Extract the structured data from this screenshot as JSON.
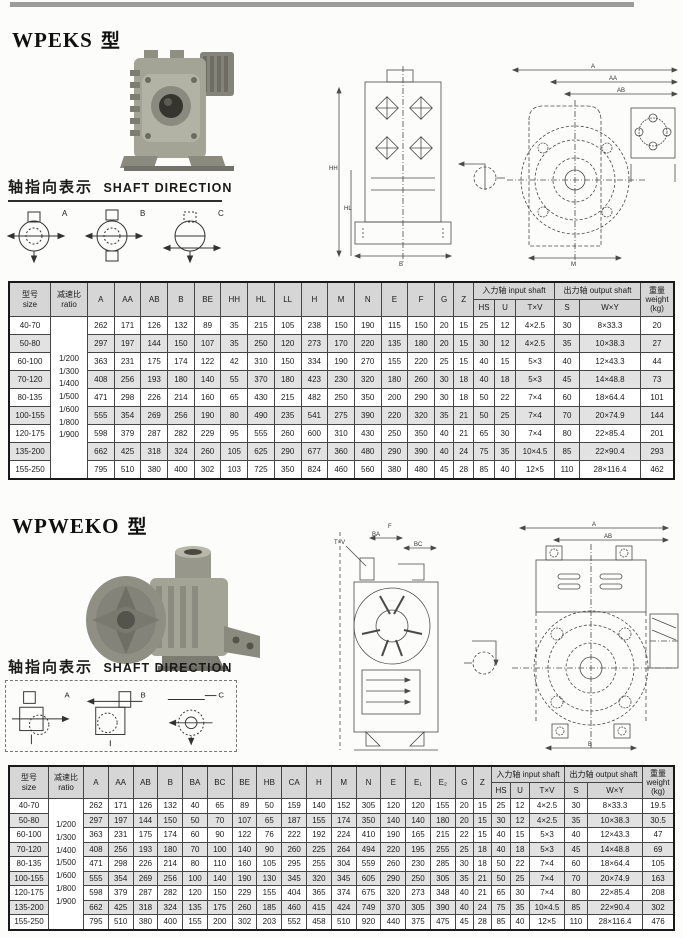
{
  "page": {
    "kind": "gear-reducer-catalog-page"
  },
  "sections": {
    "wpeks": {
      "title": "WPEKS",
      "type_suffix": "型",
      "shaft_direction_zh": "轴指向表示",
      "shaft_direction_en": "SHAFT DIRECTION",
      "sketch_labels": [
        "A",
        "B",
        "C"
      ],
      "drawing_front_labels": [
        "HH",
        "HL",
        "B"
      ],
      "drawing_side_labels": [
        "A",
        "AA",
        "AB",
        "M"
      ]
    },
    "wpweko": {
      "title": "WPWEKO",
      "type_suffix": "型",
      "shaft_direction_zh": "轴指向表示",
      "shaft_direction_en": "SHAFT DIRECTION",
      "sketch_labels": [
        "A",
        "B",
        "C"
      ],
      "drawing_left_labels": [
        "T×V",
        "F",
        "BA",
        "BC"
      ],
      "drawing_front_labels": [
        "A",
        "AB",
        "B"
      ]
    }
  },
  "tables": {
    "wpeks": {
      "header_rows": [
        [
          {
            "t": "型号\nsize",
            "rs": 2,
            "w": 38
          },
          {
            "t": "减速比\nratio",
            "rs": 2,
            "w": 34
          },
          {
            "t": "A",
            "rs": 2
          },
          {
            "t": "AA",
            "rs": 2
          },
          {
            "t": "AB",
            "rs": 2
          },
          {
            "t": "B",
            "rs": 2
          },
          {
            "t": "BE",
            "rs": 2
          },
          {
            "t": "HH",
            "rs": 2
          },
          {
            "t": "HL",
            "rs": 2
          },
          {
            "t": "LL",
            "rs": 2
          },
          {
            "t": "H",
            "rs": 2
          },
          {
            "t": "M",
            "rs": 2
          },
          {
            "t": "N",
            "rs": 2
          },
          {
            "t": "E",
            "rs": 2
          },
          {
            "t": "F",
            "rs": 2
          },
          {
            "t": "G",
            "rs": 2
          },
          {
            "t": "Z",
            "rs": 2
          },
          {
            "t": "入力轴 input shaft",
            "cs": 3
          },
          {
            "t": "出力轴 output shaft",
            "cs": 2
          },
          {
            "t": "重量\nweight\n(kg)",
            "rs": 2,
            "w": 30
          }
        ],
        [
          {
            "t": "HS",
            "w": 18
          },
          {
            "t": "U",
            "w": 18
          },
          {
            "t": "T×V",
            "w": 36
          },
          {
            "t": "S",
            "w": 22
          },
          {
            "t": "W×Y",
            "w": 58
          }
        ]
      ],
      "ratios": [
        "1/200",
        "1/300",
        "1/400",
        "1/500",
        "1/600",
        "1/800",
        "1/900"
      ],
      "rows": [
        {
          "size": "40-70",
          "values": [
            262,
            171,
            126,
            132,
            89,
            35,
            215,
            105,
            238,
            150,
            190,
            115,
            150,
            20,
            15,
            25,
            12,
            "4×2.5",
            30,
            "8×33.3",
            20
          ]
        },
        {
          "size": "50-80",
          "values": [
            297,
            197,
            144,
            150,
            107,
            35,
            250,
            120,
            273,
            170,
            220,
            135,
            180,
            20,
            15,
            30,
            12,
            "4×2.5",
            35,
            "10×38.3",
            27
          ]
        },
        {
          "size": "60-100",
          "values": [
            363,
            231,
            175,
            174,
            122,
            42,
            310,
            150,
            334,
            190,
            270,
            155,
            220,
            25,
            15,
            40,
            15,
            "5×3",
            40,
            "12×43.3",
            44
          ]
        },
        {
          "size": "70-120",
          "values": [
            408,
            256,
            193,
            180,
            140,
            55,
            370,
            180,
            423,
            230,
            320,
            180,
            260,
            30,
            18,
            40,
            18,
            "5×3",
            45,
            "14×48.8",
            73
          ]
        },
        {
          "size": "80-135",
          "values": [
            471,
            298,
            226,
            214,
            160,
            65,
            430,
            215,
            482,
            250,
            350,
            200,
            290,
            30,
            18,
            50,
            22,
            "7×4",
            60,
            "18×64.4",
            101
          ]
        },
        {
          "size": "100-155",
          "values": [
            555,
            354,
            269,
            256,
            190,
            80,
            490,
            235,
            541,
            275,
            390,
            220,
            320,
            35,
            21,
            50,
            25,
            "7×4",
            70,
            "20×74.9",
            144
          ]
        },
        {
          "size": "120-175",
          "values": [
            598,
            379,
            287,
            282,
            229,
            95,
            555,
            260,
            600,
            310,
            430,
            250,
            350,
            40,
            21,
            65,
            30,
            "7×4",
            80,
            "22×85.4",
            201
          ]
        },
        {
          "size": "135-200",
          "values": [
            662,
            425,
            318,
            324,
            260,
            105,
            625,
            290,
            677,
            360,
            480,
            290,
            390,
            40,
            24,
            75,
            35,
            "10×4.5",
            85,
            "22×90.4",
            293
          ]
        },
        {
          "size": "155-250",
          "values": [
            795,
            510,
            380,
            400,
            302,
            103,
            725,
            350,
            824,
            460,
            560,
            380,
            480,
            45,
            28,
            85,
            40,
            "12×5",
            110,
            "28×116.4",
            462
          ]
        }
      ]
    },
    "wpweko": {
      "header_rows": [
        [
          {
            "t": "型号\nsize",
            "rs": 2,
            "w": 36
          },
          {
            "t": "减速比\nratio",
            "rs": 2,
            "w": 32
          },
          {
            "t": "A",
            "rs": 2
          },
          {
            "t": "AA",
            "rs": 2
          },
          {
            "t": "AB",
            "rs": 2
          },
          {
            "t": "B",
            "rs": 2
          },
          {
            "t": "BA",
            "rs": 2
          },
          {
            "t": "BC",
            "rs": 2
          },
          {
            "t": "BE",
            "rs": 2
          },
          {
            "t": "HB",
            "rs": 2
          },
          {
            "t": "CA",
            "rs": 2
          },
          {
            "t": "H",
            "rs": 2
          },
          {
            "t": "M",
            "rs": 2
          },
          {
            "t": "N",
            "rs": 2
          },
          {
            "t": "E",
            "rs": 2
          },
          {
            "t": "E₁",
            "rs": 2
          },
          {
            "t": "E₂",
            "rs": 2
          },
          {
            "t": "G",
            "rs": 2
          },
          {
            "t": "Z",
            "rs": 2
          },
          {
            "t": "入力轴 input shaft",
            "cs": 3
          },
          {
            "t": "出力轴 output shaft",
            "cs": 2
          },
          {
            "t": "重量\nweight\n(kg)",
            "rs": 2,
            "w": 28
          }
        ],
        [
          {
            "t": "HS",
            "w": 16
          },
          {
            "t": "U",
            "w": 16
          },
          {
            "t": "T×V",
            "w": 32
          },
          {
            "t": "S",
            "w": 20
          },
          {
            "t": "W×Y",
            "w": 52
          }
        ]
      ],
      "ratios": [
        "1/200",
        "1/300",
        "1/400",
        "1/500",
        "1/600",
        "1/800",
        "1/900"
      ],
      "rows": [
        {
          "size": "40-70",
          "values": [
            262,
            171,
            126,
            132,
            40,
            65,
            89,
            50,
            159,
            140,
            152,
            305,
            120,
            120,
            155,
            20,
            15,
            25,
            12,
            "4×2.5",
            30,
            "8×33.3",
            19.5
          ]
        },
        {
          "size": "50-80",
          "values": [
            297,
            197,
            144,
            150,
            50,
            70,
            107,
            65,
            187,
            155,
            174,
            350,
            140,
            140,
            180,
            20,
            15,
            30,
            12,
            "4×2.5",
            35,
            "10×38.3",
            30.5
          ]
        },
        {
          "size": "60-100",
          "values": [
            363,
            231,
            175,
            174,
            60,
            90,
            122,
            76,
            222,
            192,
            224,
            410,
            190,
            165,
            215,
            22,
            15,
            40,
            15,
            "5×3",
            40,
            "12×43.3",
            47
          ]
        },
        {
          "size": "70-120",
          "values": [
            408,
            256,
            193,
            180,
            70,
            100,
            140,
            90,
            260,
            225,
            264,
            494,
            220,
            195,
            255,
            25,
            18,
            40,
            18,
            "5×3",
            45,
            "14×48.8",
            69
          ]
        },
        {
          "size": "80-135",
          "values": [
            471,
            298,
            226,
            214,
            80,
            110,
            160,
            105,
            295,
            255,
            304,
            559,
            260,
            230,
            285,
            30,
            18,
            50,
            22,
            "7×4",
            60,
            "18×64.4",
            105
          ]
        },
        {
          "size": "100-155",
          "values": [
            555,
            354,
            269,
            256,
            100,
            140,
            190,
            130,
            345,
            320,
            345,
            605,
            290,
            250,
            305,
            35,
            21,
            50,
            25,
            "7×4",
            70,
            "20×74.9",
            163
          ]
        },
        {
          "size": "120-175",
          "values": [
            598,
            379,
            287,
            282,
            120,
            150,
            229,
            155,
            404,
            365,
            374,
            675,
            320,
            273,
            348,
            40,
            21,
            65,
            30,
            "7×4",
            80,
            "22×85.4",
            208
          ]
        },
        {
          "size": "135-200",
          "values": [
            662,
            425,
            318,
            324,
            135,
            175,
            260,
            185,
            460,
            415,
            424,
            749,
            370,
            305,
            390,
            40,
            24,
            75,
            35,
            "10×4.5",
            85,
            "22×90.4",
            302
          ]
        },
        {
          "size": "155-250",
          "values": [
            795,
            510,
            380,
            400,
            155,
            200,
            302,
            203,
            552,
            458,
            510,
            920,
            440,
            375,
            475,
            45,
            28,
            85,
            40,
            "12×5",
            110,
            "28×116.4",
            476
          ]
        }
      ]
    }
  }
}
